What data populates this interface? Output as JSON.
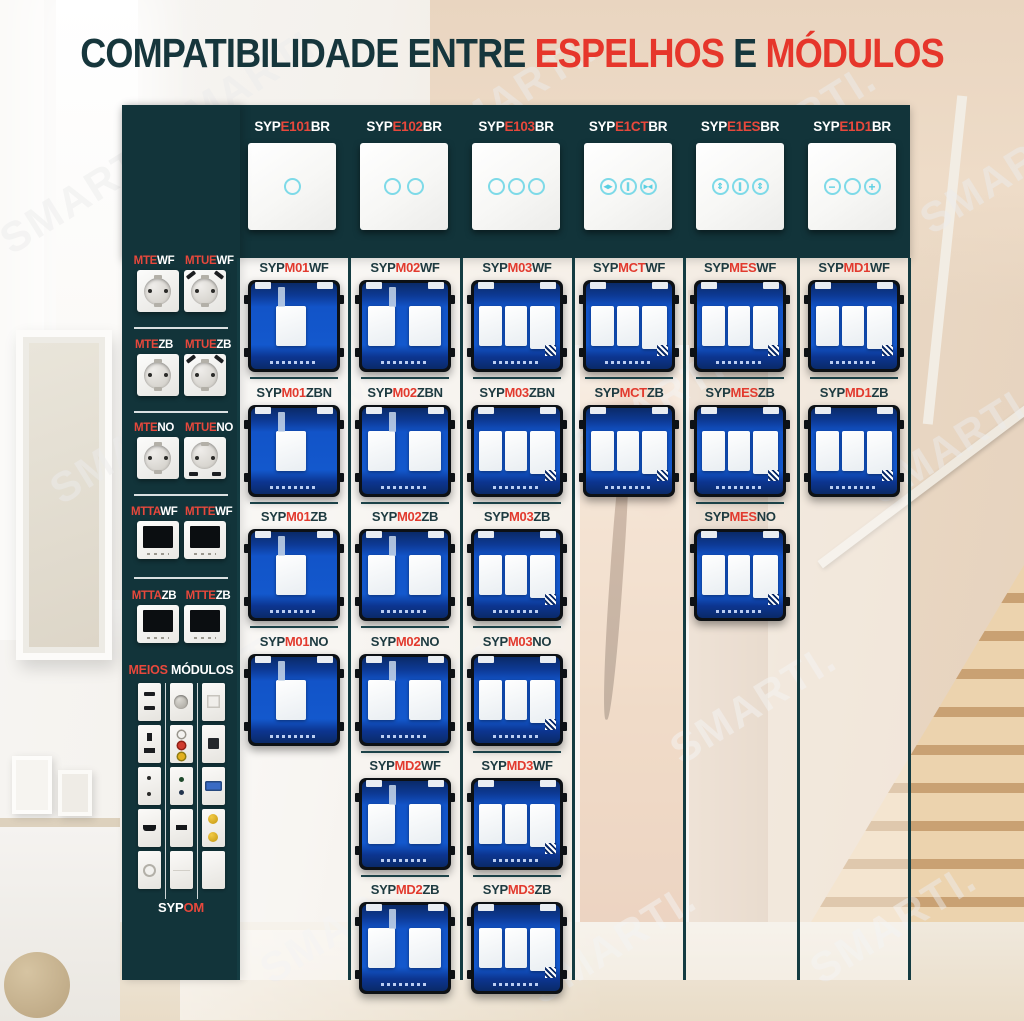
{
  "watermark": {
    "text": "SMARTI."
  },
  "title": {
    "p1": "COMPATIBILIDADE ENTRE ",
    "p2": "ESPELHOS",
    "p3": " E ",
    "p4": "MÓDULOS"
  },
  "colors": {
    "teal": "#12343a",
    "red": "#e6362b",
    "module_blue": "#1358cd",
    "module_navy": "#0a2a68",
    "touch_cyan": "#7edae8",
    "panel_veil": "rgba(255,255,255,0.42)"
  },
  "espelhos": [
    {
      "prefix": "SYP",
      "code": "E100",
      "suffix": "BR",
      "type": "frame"
    },
    {
      "prefix": "SYP",
      "code": "E101",
      "suffix": "BR",
      "type": "touch-1"
    },
    {
      "prefix": "SYP",
      "code": "E102",
      "suffix": "BR",
      "type": "touch-2"
    },
    {
      "prefix": "SYP",
      "code": "E103",
      "suffix": "BR",
      "type": "touch-3"
    },
    {
      "prefix": "SYP",
      "code": "E1CT",
      "suffix": "BR",
      "type": "curtain",
      "icons": [
        "◂▸",
        "∥",
        "▸◂"
      ]
    },
    {
      "prefix": "SYP",
      "code": "E1ES",
      "suffix": "BR",
      "type": "shutter",
      "icons": [
        "⇕",
        "∥",
        "⇕"
      ]
    },
    {
      "prefix": "SYP",
      "code": "E1D1",
      "suffix": "BR",
      "type": "dimmer",
      "icons": [
        "−",
        "",
        "+"
      ]
    }
  ],
  "sidebar": {
    "rows": [
      {
        "items": [
          {
            "code": "MTE",
            "suffix": "WF"
          },
          {
            "code": "MTUE",
            "suffix": "WF"
          }
        ]
      },
      {
        "items": [
          {
            "code": "MTE",
            "suffix": "ZB"
          },
          {
            "code": "MTUE",
            "suffix": "ZB"
          }
        ]
      },
      {
        "items": [
          {
            "code": "MTE",
            "suffix": "NO"
          },
          {
            "code": "MTUE",
            "suffix": "NO"
          }
        ]
      },
      {
        "items": [
          {
            "code": "MTTA",
            "suffix": "WF"
          },
          {
            "code": "MTTE",
            "suffix": "WF"
          }
        ]
      },
      {
        "items": [
          {
            "code": "MTTA",
            "suffix": "ZB"
          },
          {
            "code": "MTTE",
            "suffix": "ZB"
          }
        ]
      }
    ],
    "meios": {
      "label_red": "MEIOS",
      "label_rest": " MÓDULOS",
      "items": [
        "usb-double",
        "tv-round",
        "keystone-blank",
        "usb-charger",
        "rca-triple",
        "rj45",
        "socket-2pin",
        "audio-jacks",
        "vga",
        "hdmi",
        "usb-single",
        "sat-double",
        "coax",
        "rocker-blank",
        "plate-blank"
      ]
    },
    "sypom": {
      "prefix": "SYP",
      "code": "OM"
    }
  },
  "columns": [
    {
      "gangs": 1,
      "modules": [
        {
          "prefix": "SYP",
          "code": "M01",
          "suffix": "WF"
        },
        {
          "prefix": "SYP",
          "code": "M01",
          "suffix": "ZBN"
        },
        {
          "prefix": "SYP",
          "code": "M01",
          "suffix": "ZB"
        },
        {
          "prefix": "SYP",
          "code": "M01",
          "suffix": "NO"
        }
      ]
    },
    {
      "gangs": 2,
      "modules": [
        {
          "prefix": "SYP",
          "code": "M02",
          "suffix": "WF"
        },
        {
          "prefix": "SYP",
          "code": "M02",
          "suffix": "ZBN"
        },
        {
          "prefix": "SYP",
          "code": "M02",
          "suffix": "ZB"
        },
        {
          "prefix": "SYP",
          "code": "M02",
          "suffix": "NO"
        },
        {
          "prefix": "SYP",
          "code": "MD2",
          "suffix": "WF"
        },
        {
          "prefix": "SYP",
          "code": "MD2",
          "suffix": "ZB"
        }
      ]
    },
    {
      "gangs": 3,
      "modules": [
        {
          "prefix": "SYP",
          "code": "M03",
          "suffix": "WF"
        },
        {
          "prefix": "SYP",
          "code": "M03",
          "suffix": "ZBN"
        },
        {
          "prefix": "SYP",
          "code": "M03",
          "suffix": "ZB"
        },
        {
          "prefix": "SYP",
          "code": "M03",
          "suffix": "NO"
        },
        {
          "prefix": "SYP",
          "code": "MD3",
          "suffix": "WF"
        },
        {
          "prefix": "SYP",
          "code": "MD3",
          "suffix": "ZB"
        }
      ]
    },
    {
      "gangs": 3,
      "modules": [
        {
          "prefix": "SYP",
          "code": "MCT",
          "suffix": "WF"
        },
        {
          "prefix": "SYP",
          "code": "MCT",
          "suffix": "ZB"
        }
      ]
    },
    {
      "gangs": 3,
      "modules": [
        {
          "prefix": "SYP",
          "code": "MES",
          "suffix": "WF"
        },
        {
          "prefix": "SYP",
          "code": "MES",
          "suffix": "ZB"
        },
        {
          "prefix": "SYP",
          "code": "MES",
          "suffix": "NO"
        }
      ]
    },
    {
      "gangs": 3,
      "modules": [
        {
          "prefix": "SYP",
          "code": "MD1",
          "suffix": "WF"
        },
        {
          "prefix": "SYP",
          "code": "MD1",
          "suffix": "ZB"
        }
      ]
    }
  ]
}
